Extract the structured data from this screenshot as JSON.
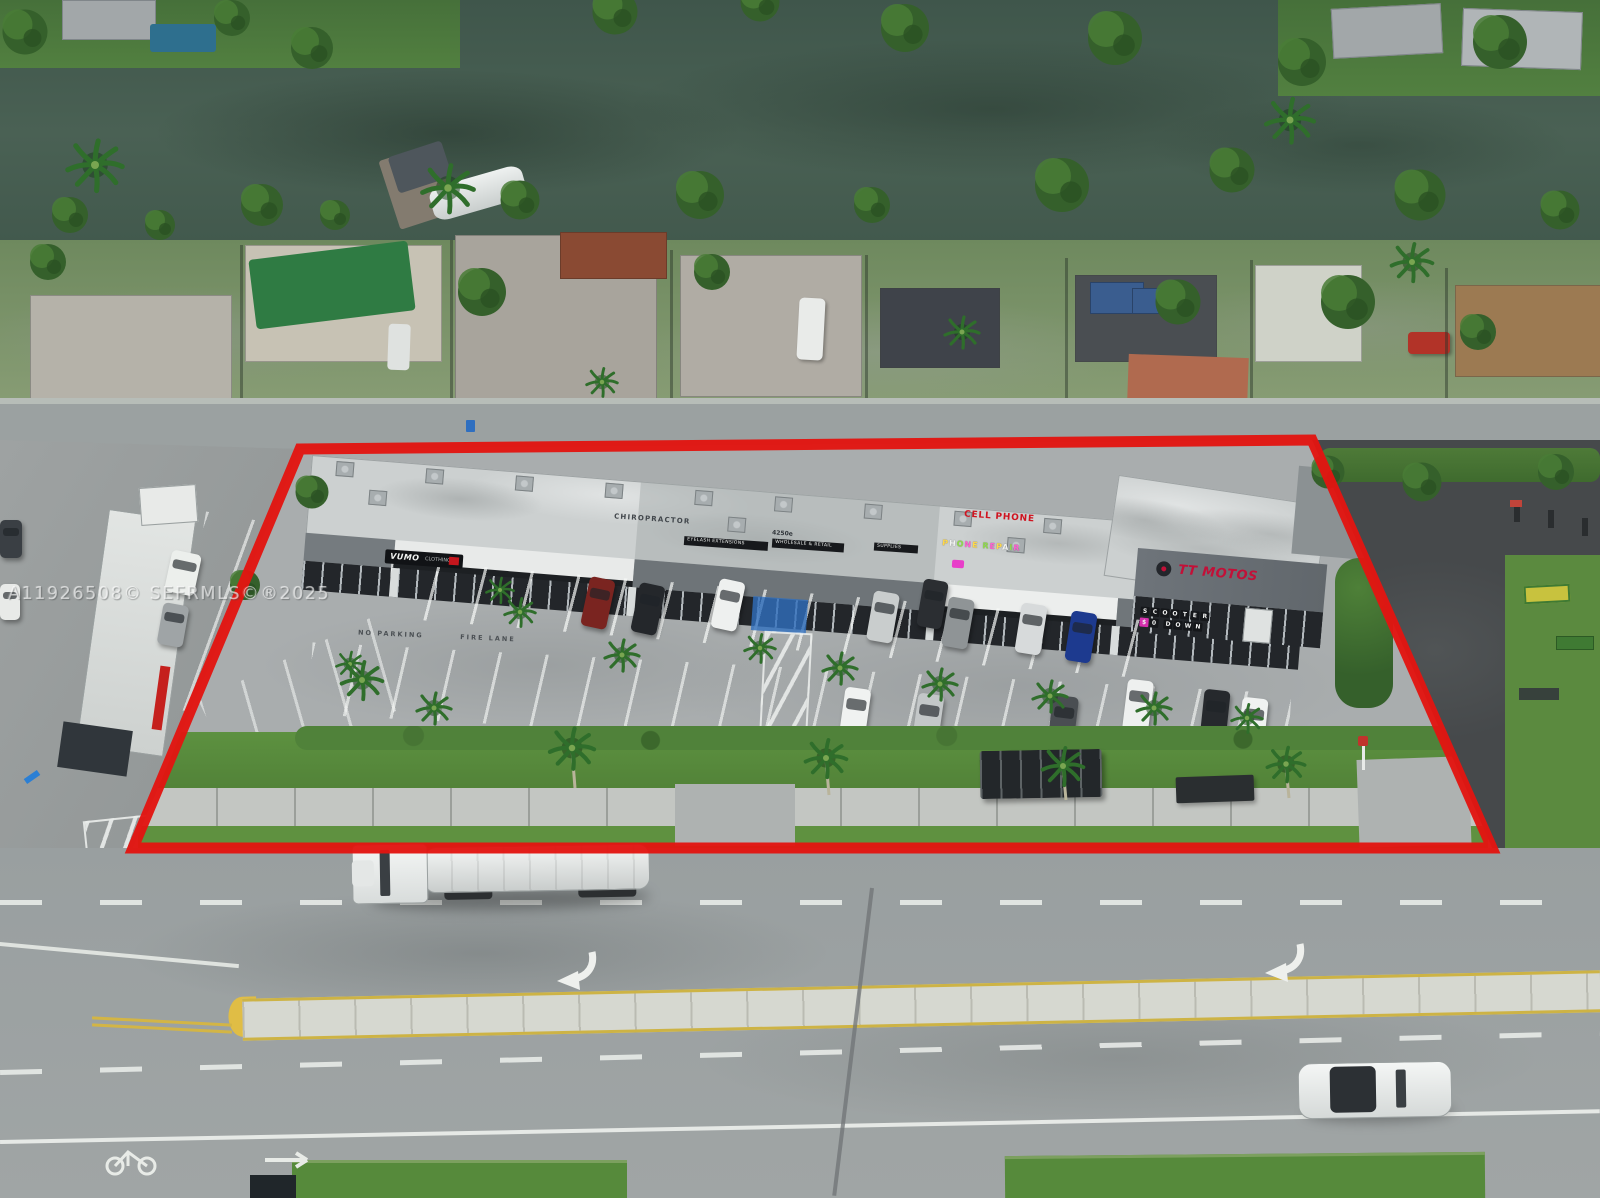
{
  "watermark": {
    "text": "A11926508© SEFRMLS©®2025"
  },
  "property": {
    "boundary_color": "#e21511",
    "signs": {
      "vumo": "VUMO",
      "vumo_sub": "CLOTHING",
      "chiropractor": "CHIROPRACTOR",
      "address": "4250e",
      "eyelash": "EYELASH EXTENSIONS",
      "wholesale": "WHOLESALE & RETAIL",
      "supplies": "SUPPLIES",
      "cell_phone": "CELL PHONE",
      "phone_repair": "PHONE REPAIR",
      "tt_motos": "TT MOTOS",
      "scooter_row1": "SCOOTER",
      "scooter_row2": "$0 DOWN"
    },
    "pavement": {
      "no_parking": "NO PARKING",
      "fire_lane": "FIRE LANE"
    }
  },
  "colors": {
    "boundary_red": "#e21511",
    "sign_red": "#cf1420",
    "tt_red": "#c21038",
    "water_green": "#46604f",
    "grass_green": "#568a3b",
    "median_yellow": "#cdb345"
  }
}
